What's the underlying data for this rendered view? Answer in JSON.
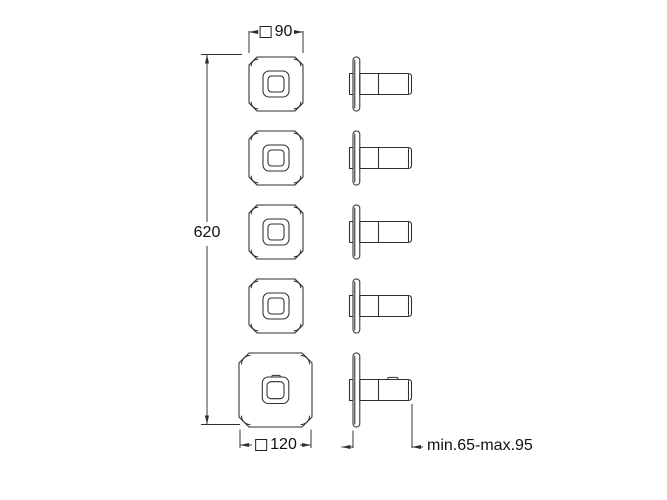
{
  "page": {
    "background": "#ffffff",
    "line_color": "#2e2e2e",
    "text_color": "#111111"
  },
  "drawing": {
    "type": "technical-dimension-drawing",
    "views": {
      "front_handles_small_count": 4,
      "front_plate_large_count": 1,
      "side_profiles_count": 5
    },
    "dims": {
      "width_small": {
        "symbol": "square",
        "value": "90"
      },
      "total_height": {
        "value": "620"
      },
      "width_large": {
        "symbol": "square",
        "value": "120"
      },
      "depth_range": {
        "value": "min.65-max.95"
      }
    }
  }
}
